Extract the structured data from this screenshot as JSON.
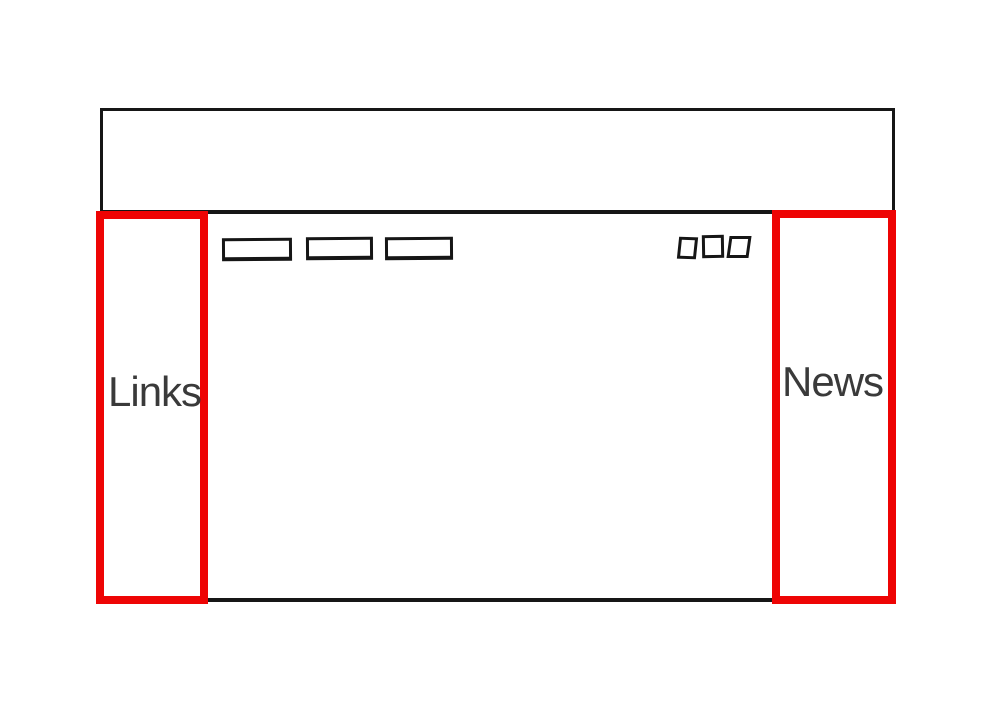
{
  "sidebars": {
    "left": {
      "label": "Links"
    },
    "right": {
      "label": "News"
    }
  },
  "toolbar": {
    "nav_placeholder_count": 3,
    "icon_placeholder_count": 3
  },
  "colors": {
    "annotation_red": "#ee0404",
    "sketch_black": "#161616",
    "label_gray": "#3a3a3a",
    "background": "#ffffff"
  }
}
